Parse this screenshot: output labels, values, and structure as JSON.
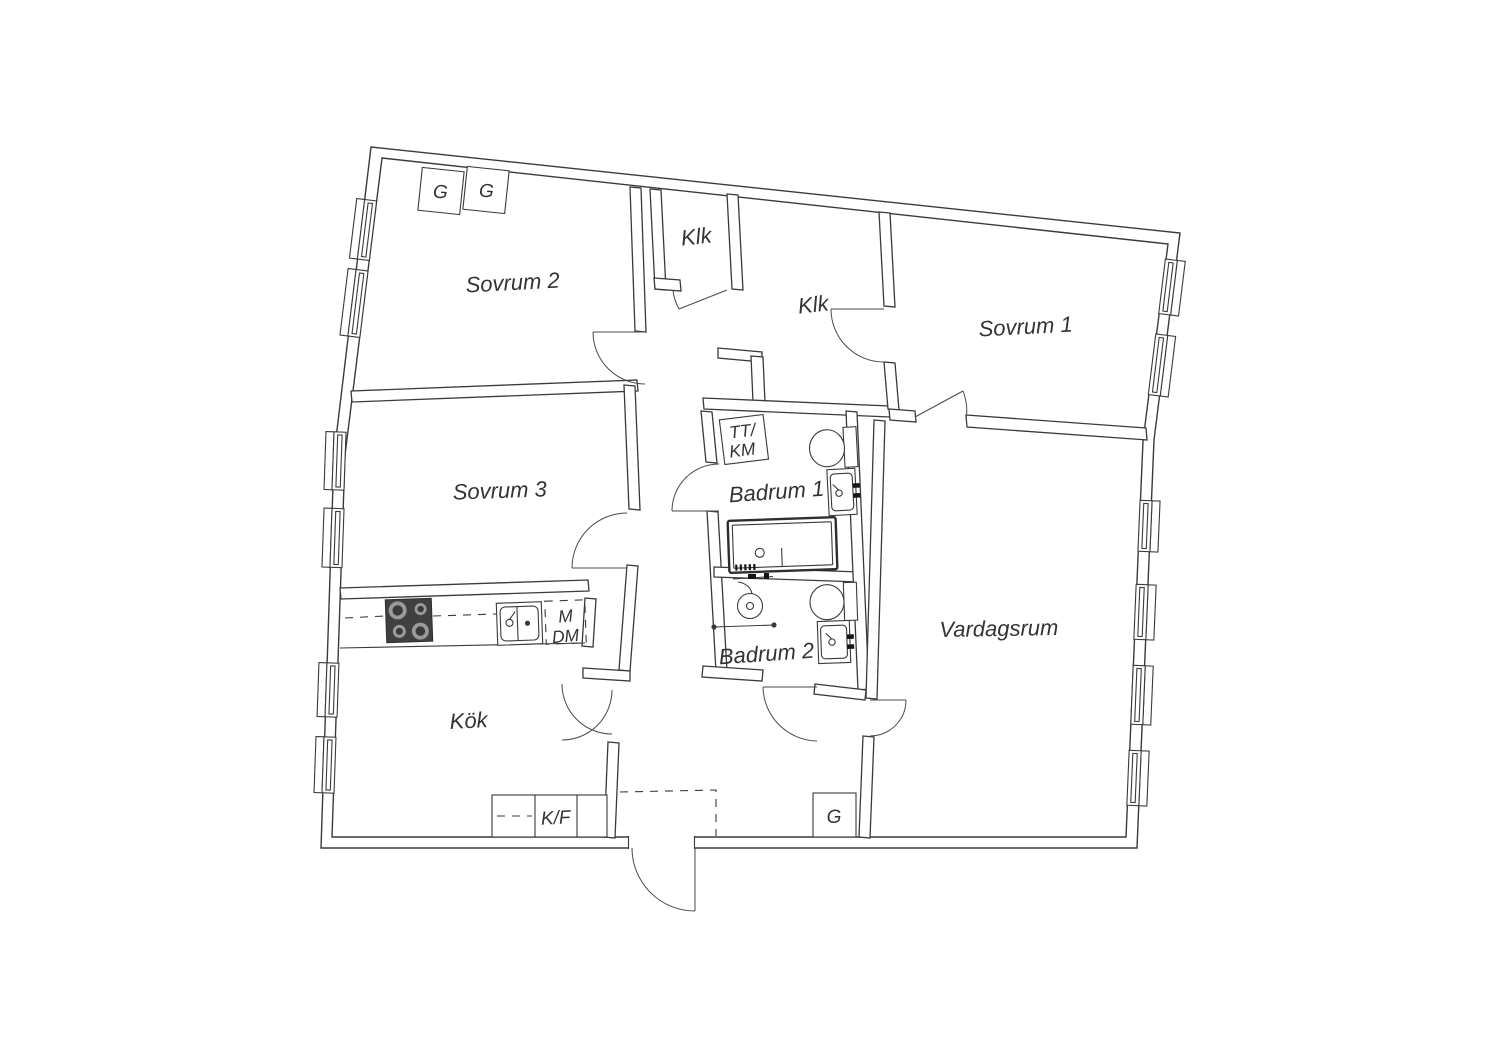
{
  "title": "Apartment floor plan",
  "colors": {
    "background": "#ffffff",
    "line": "#3a3a3a",
    "text": "#333333",
    "appliance_dark": "#404040",
    "burner_ring": "#9a9a9a"
  },
  "rooms": {
    "sovrum2": "Sovrum 2",
    "klk_top": "Klk",
    "klk_right": "Klk",
    "sovrum1": "Sovrum 1",
    "sovrum3": "Sovrum 3",
    "badrum1": "Badrum 1",
    "badrum2": "Badrum 2",
    "vardagsrum": "Vardagsrum",
    "kok": "Kök"
  },
  "fixtures": {
    "wardrobe_1": "G",
    "wardrobe_2": "G",
    "wardrobe_hall": "G",
    "fridge_freezer": "K/F",
    "microwave": "M",
    "dishwasher": "DM",
    "laundry_line1": "TT/",
    "laundry_line2": "KM"
  }
}
